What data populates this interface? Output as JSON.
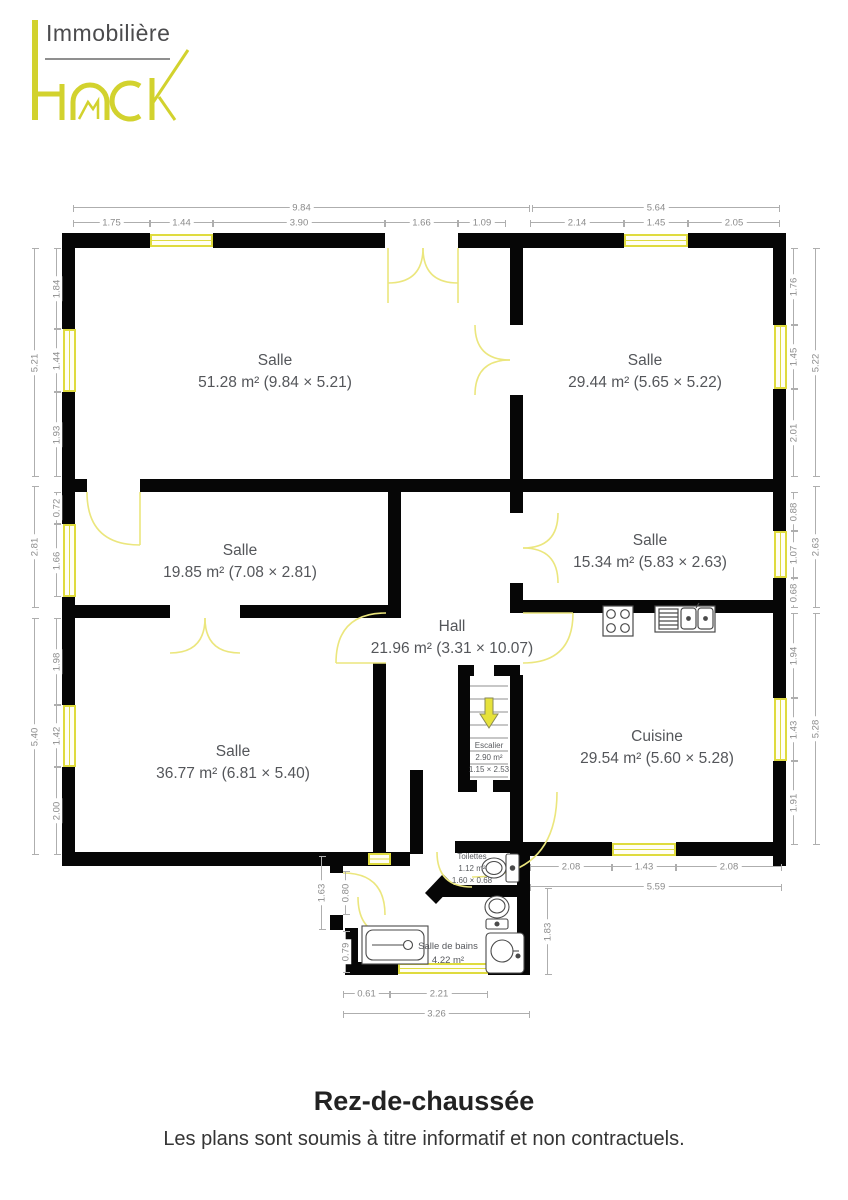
{
  "brand": {
    "top": "Immobilière",
    "name": "HACK"
  },
  "colors": {
    "accent": "#d2d22e",
    "wall": "#060606",
    "door": "#ebe67d",
    "window_border": "#dfdb3e",
    "dim_line": "#aeaeae",
    "room_label": "#54565a"
  },
  "rooms": {
    "salle1": {
      "name": "Salle",
      "details": "51.28 m² (9.84 × 5.21)"
    },
    "salle2": {
      "name": "Salle",
      "details": "29.44 m² (5.65 × 5.22)"
    },
    "salle3": {
      "name": "Salle",
      "details": "19.85 m² (7.08 × 2.81)"
    },
    "salle4": {
      "name": "Salle",
      "details": "15.34 m² (5.83 × 2.63)"
    },
    "hall": {
      "name": "Hall",
      "details": "21.96 m² (3.31 × 10.07)"
    },
    "salle5": {
      "name": "Salle",
      "details": "36.77 m² (6.81 × 5.40)"
    },
    "cuisine": {
      "name": "Cuisine",
      "details": "29.54 m² (5.60 × 5.28)"
    },
    "escalier": {
      "name": "Escalier",
      "area": "2.90 m²",
      "size": "1.15 × 2.53"
    },
    "toilettes": {
      "name": "Toilettes",
      "area": "1.12 m²",
      "size": "1.60 × 0.68"
    },
    "salle_de_bains": {
      "name": "Salle de bains",
      "area": "4.22 m²"
    }
  },
  "dims": {
    "top_outer": [
      "9.84",
      "5.64"
    ],
    "top_inner": [
      "1.75",
      "1.44",
      "3.90",
      "1.66",
      "1.09",
      "2.14",
      "1.45",
      "2.05"
    ],
    "left_outer": [
      "5.21",
      "2.81",
      "5.40"
    ],
    "left_inner": [
      "1.84",
      "1.44",
      "1.93",
      "0.72",
      "1.66",
      "1.98",
      "1.42",
      "2.00"
    ],
    "right_outer": [
      "5.22",
      "2.63",
      "5.28"
    ],
    "right_inner": [
      "1.76",
      "1.45",
      "2.01",
      "0.88",
      "1.07",
      "0.68",
      "1.94",
      "1.43",
      "1.91"
    ],
    "kitchen_bottom": [
      "2.08",
      "1.43",
      "2.08"
    ],
    "kitchen_bottom_total": "5.59",
    "bath_left": [
      "1.63",
      "0.80",
      "0.79"
    ],
    "bath_right": "1.83",
    "bath_bottom": [
      "0.61",
      "2.21"
    ],
    "bath_bottom_total": "3.26"
  },
  "footer": {
    "title": "Rez-de-chaussée",
    "disclaimer": "Les plans sont soumis à titre informatif et non contractuels."
  }
}
